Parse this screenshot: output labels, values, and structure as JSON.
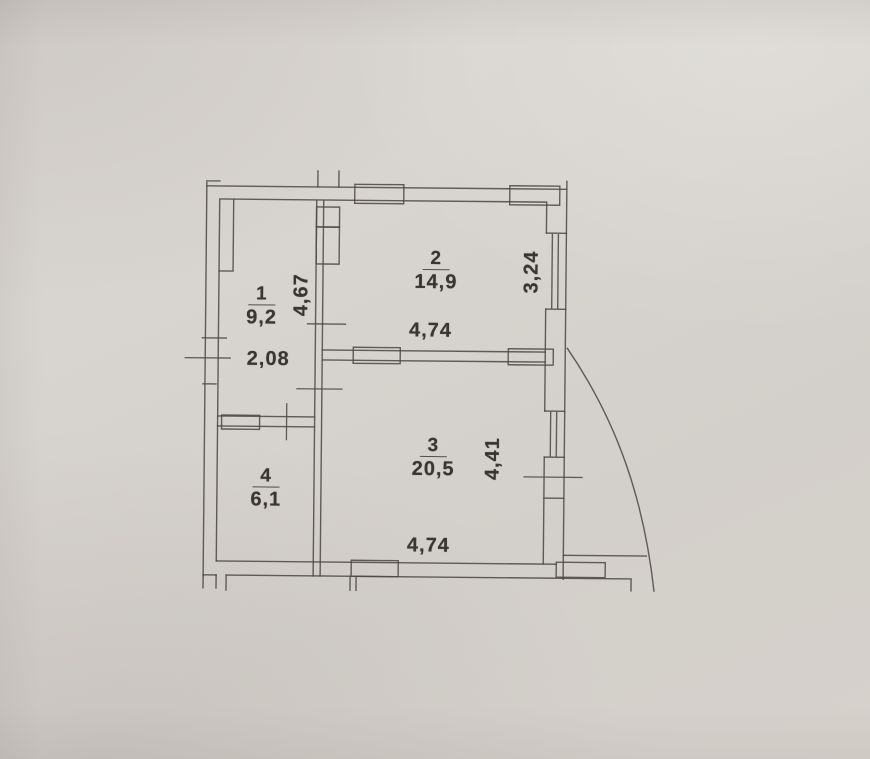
{
  "document": {
    "kind": "apartment floor plan (photographed paper drawing)",
    "colors": {
      "paper": "#d6d2cd",
      "ink": "#4e4a46",
      "text": "#3a3631"
    }
  },
  "plan": {
    "rooms": [
      {
        "number": "1",
        "area": "9,2"
      },
      {
        "number": "2",
        "area": "14,9"
      },
      {
        "number": "3",
        "area": "20,5"
      },
      {
        "number": "4",
        "area": "6,1"
      }
    ],
    "dimensions": {
      "rooms12_height": "4,67",
      "room1_width": "2,08",
      "room2_width": "4,74",
      "room2_window_side": "3,24",
      "room3_height": "4,41",
      "room3_width": "4,74"
    }
  }
}
